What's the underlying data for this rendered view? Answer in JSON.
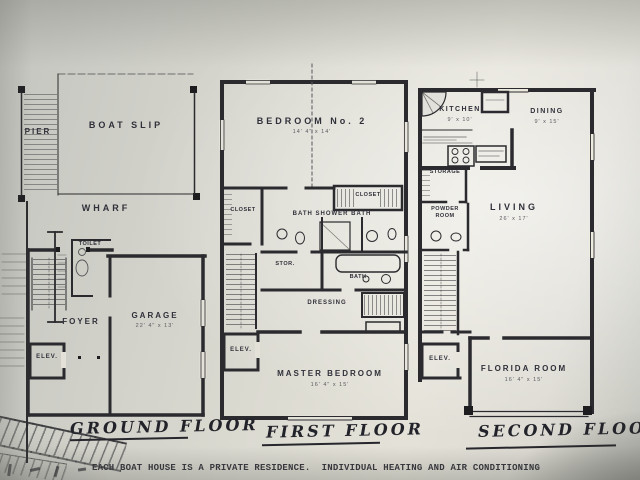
{
  "colors": {
    "ink": "#2e2e32",
    "paper": "#e2e0d7"
  },
  "caption": "EACH BOAT HOUSE IS A PRIVATE RESIDENCE.  INDIVIDUAL HEATING AND AIR CONDITIONING",
  "plans": {
    "ground": {
      "title": "GROUND FLOOR",
      "pier": "PIER",
      "boat_slip": "BOAT SLIP",
      "wharf": "WHARF",
      "toilet": "TOILET",
      "foyer": "FOYER",
      "garage": "GARAGE",
      "garage_dim": "22' 4\" x 13'",
      "elevator": "ELEV."
    },
    "first": {
      "title": "FIRST FLOOR",
      "bedroom2": "BEDROOM No. 2",
      "bedroom2_dim": "14' 4\" x 14'",
      "closet_a": "CLOSET",
      "closet_b": "CLOSET",
      "bath_shower_bath": "BATH  SHOWER  BATH",
      "storage": "STOR.",
      "bath": "BATH",
      "dressing": "DRESSING",
      "elevator": "ELEV.",
      "master_bedroom": "MASTER  BEDROOM",
      "master_dim": "16' 4\" x 15'"
    },
    "second": {
      "title": "SECOND FLOOR",
      "kitchen": "KITCHEN",
      "kitchen_dim": "9' x 10'",
      "dining": "DINING",
      "dining_dim": "9' x 15'",
      "storage": "STORAGE",
      "powder_room": "POWDER ROOM",
      "living": "LIVING",
      "living_dim": "26' x 17'",
      "elevator": "ELEV.",
      "florida_room": "FLORIDA ROOM",
      "florida_dim": "16' 4\" x 15'"
    }
  }
}
